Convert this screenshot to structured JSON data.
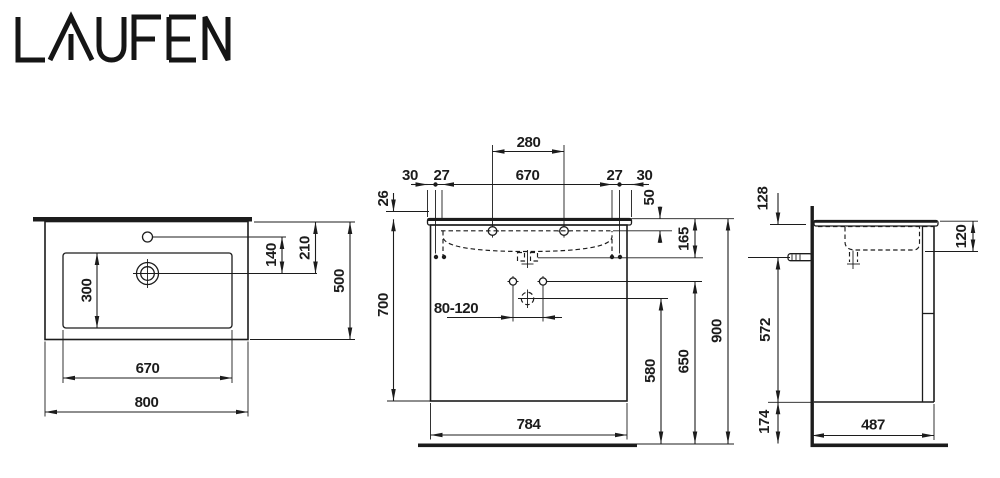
{
  "logo": {
    "text": "LAUFEN"
  },
  "colors": {
    "ink": "#1c1c1c",
    "background": "#ffffff"
  },
  "drawing": {
    "top_view": {
      "dims": {
        "basin_depth": "300",
        "tap_to_drain": "140",
        "edge_to_drain": "210",
        "total_depth": "500",
        "basin_width": "670",
        "total_width": "800"
      }
    },
    "front_view": {
      "dims": {
        "tap_spacing": "280",
        "edge_left": "30",
        "dowel_left": "27",
        "basin_width": "670",
        "dowel_right": "27",
        "edge_right": "30",
        "rim_height": "26",
        "top_to_taphole": "50",
        "basin_height": "165",
        "fixing_range": "80-120",
        "top_to_bottom": "700",
        "drain_height": "580",
        "fixing_height": "650",
        "total_height": "900",
        "cabinet_width": "784"
      }
    },
    "side_view": {
      "dims": {
        "top_to_siphon": "128",
        "bowl_depth": "120",
        "cabinet_height": "572",
        "floor_clearance": "174",
        "cabinet_depth": "487"
      }
    }
  }
}
